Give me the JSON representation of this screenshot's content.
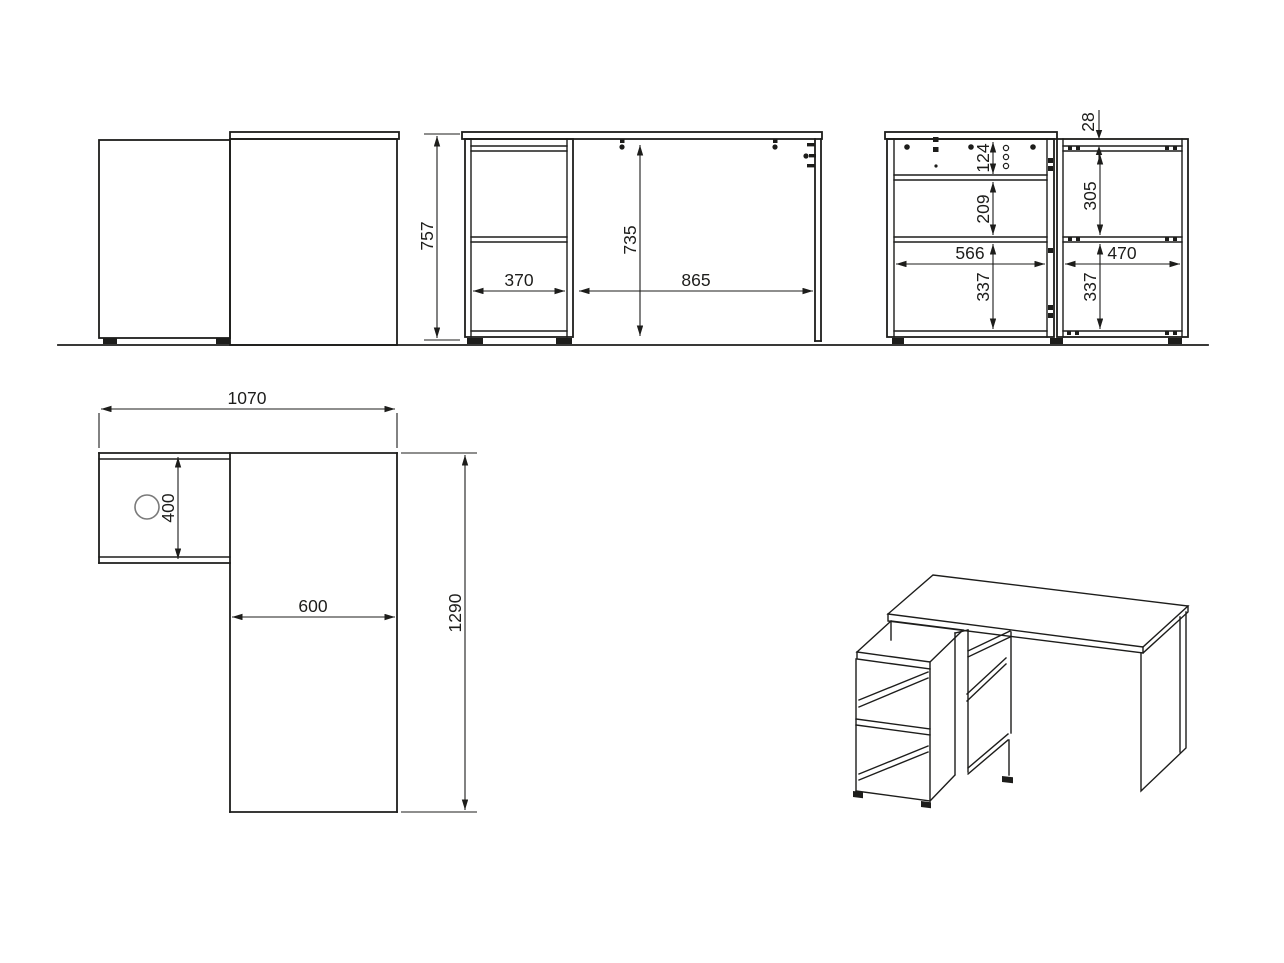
{
  "colors": {
    "line": "#1d1d1b",
    "background": "#ffffff",
    "circle": "#7a7a7a"
  },
  "dimensions": {
    "overall_height": "757",
    "cabinet_width": "370",
    "clear_height": "735",
    "desk_span": "865",
    "top_thickness": "28",
    "back_top_band": "124",
    "back_shelf_gap": "209",
    "back_left_width": "566",
    "back_left_lower": "337",
    "back_right_gap": "305",
    "back_right_width": "470",
    "back_right_lower": "337",
    "top_total_width": "1070",
    "top_return_depth": "400",
    "top_desk_width": "600",
    "top_total_length": "1290"
  }
}
